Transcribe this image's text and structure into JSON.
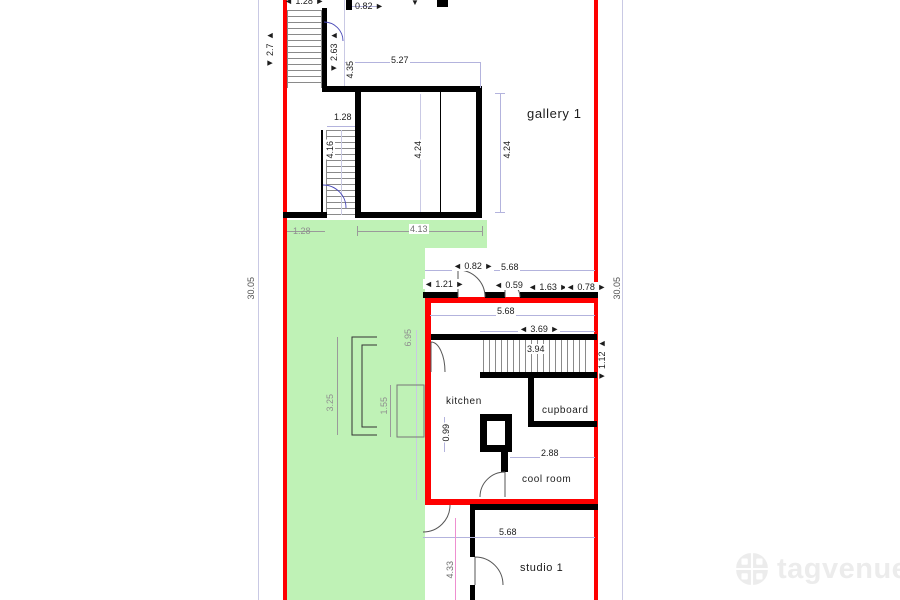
{
  "rooms": {
    "gallery": "gallery 1",
    "kitchen": "kitchen",
    "cupboard": "cupboard",
    "cool_room": "cool room",
    "studio": "studio 1"
  },
  "dims": {
    "d_128_top": "◄ 1.28 ►",
    "d_082_top": "0.82 ►",
    "d_arrow_top": "▼",
    "d_27": "◄ 2.7 ►",
    "d_263": "◄ 2.63 ►",
    "d_435": "4.35",
    "d_527": "5.27",
    "d_128_stair": "1.28",
    "d_416": "4.16",
    "d_424_in": "4.24",
    "d_424_r": "4.24",
    "d_3005_l": "30.05",
    "d_3005_r": "30.05",
    "d_128_green": "1.28",
    "d_413": "4.13",
    "d_082_mid": "◄ 0.82 ►",
    "d_568_a": "5.68",
    "d_121": "◄ 1.21 ►",
    "d_059": "◄ 0.59 ►",
    "d_163": "◄ 1.63 ►",
    "d_078": "◄ 0.78 ►",
    "d_568_b": "5.68",
    "d_369": "◄ 3.69 ►",
    "d_394": "3.94",
    "d_112": "◄ 1.12 ►",
    "d_695": "6.95",
    "d_325": "3.25",
    "d_155": "1.55",
    "d_099": "0.99",
    "d_288": "2.88",
    "d_568_c": "5.68",
    "d_433": "4.33"
  },
  "colors": {
    "wall_red": "#fe0000",
    "area_green": "#bff2b6",
    "dim_line": "#b3b3dd",
    "dim_pink": "#ee8fd0"
  },
  "watermark": {
    "brand": "tagvenue"
  }
}
